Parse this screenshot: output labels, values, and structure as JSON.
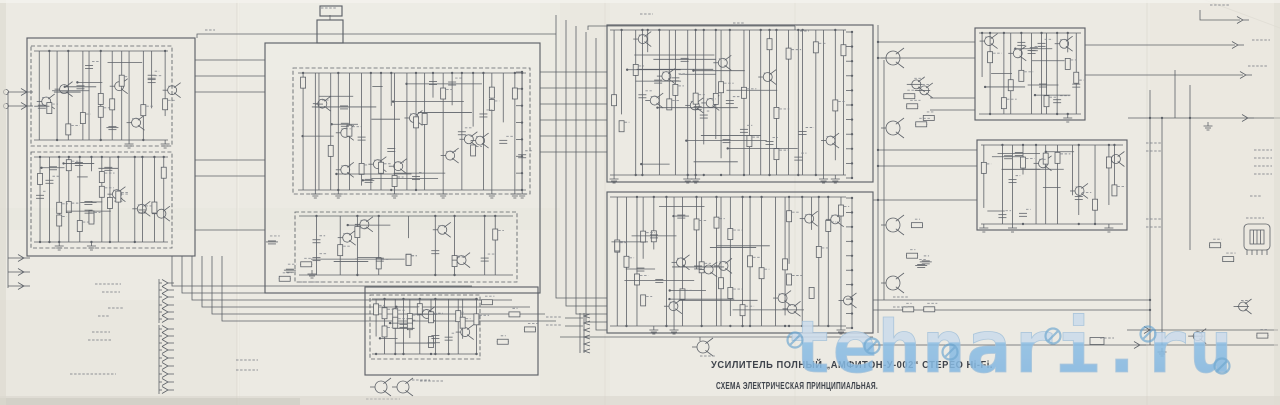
{
  "titles": {
    "line1": "УСИЛИТЕЛЬ ПОЛНЫЙ „АМФИТОН-У-002“ СТЕРЕО Hi-Fi.",
    "line2": "СХЕМА ЭЛЕКТРИЧЕСКАЯ ПРИНЦИПИАЛЬНАЯ."
  },
  "watermark": {
    "text": "tehnari.ru"
  },
  "colors": {
    "paper": "#eceae3",
    "ink": "#4e535b",
    "label": "#7f838a",
    "title": "#3e434b",
    "wm_top": "#cbdbec",
    "wm_bottom": "#8cbee5",
    "wm_outline": "#a2c1da",
    "wm_stamp": "#5e9fce"
  },
  "diagram": {
    "boxes": [
      [
        27,
        38,
        168,
        218,
        0
      ],
      [
        31,
        46,
        141,
        100,
        1
      ],
      [
        31,
        152,
        141,
        96,
        1
      ],
      [
        265,
        43,
        275,
        250,
        0
      ],
      [
        317,
        20,
        26,
        23,
        0
      ],
      [
        320,
        6,
        22,
        10,
        0
      ],
      [
        293,
        68,
        237,
        126,
        1
      ],
      [
        295,
        212,
        222,
        70,
        1
      ],
      [
        365,
        287,
        173,
        88,
        0
      ],
      [
        370,
        295,
        110,
        64,
        1
      ],
      [
        607,
        25,
        266,
        157,
        0
      ],
      [
        607,
        192,
        266,
        141,
        0
      ],
      [
        975,
        28,
        110,
        92,
        0
      ],
      [
        977,
        140,
        150,
        90,
        0
      ]
    ],
    "wires": [
      [
        197,
        38,
        197,
        34,
        556,
        34
      ],
      [
        588,
        30,
        588,
        26,
        795,
        26
      ],
      [
        795,
        26,
        795,
        30
      ],
      [
        556,
        15,
        556,
        298,
        607,
        298
      ],
      [
        566,
        20,
        566,
        306,
        607,
        306
      ],
      [
        576,
        26,
        576,
        314,
        607,
        314
      ],
      [
        586,
        32,
        586,
        322,
        607,
        322
      ],
      [
        596,
        38,
        596,
        330,
        607,
        330
      ],
      [
        195,
        60,
        265,
        60
      ],
      [
        195,
        76,
        265,
        76
      ],
      [
        195,
        92,
        265,
        92
      ],
      [
        195,
        160,
        265,
        160
      ],
      [
        195,
        176,
        265,
        176
      ],
      [
        195,
        230,
        265,
        230
      ],
      [
        540,
        72,
        607,
        72
      ],
      [
        540,
        88,
        607,
        88
      ],
      [
        540,
        104,
        607,
        104
      ],
      [
        540,
        120,
        607,
        120
      ],
      [
        540,
        136,
        607,
        136
      ],
      [
        540,
        152,
        607,
        152
      ],
      [
        172,
        256,
        172,
        286,
        472,
        286
      ],
      [
        182,
        256,
        182,
        293,
        492,
        293
      ],
      [
        192,
        256,
        192,
        300,
        512,
        300
      ],
      [
        202,
        256,
        202,
        307,
        530,
        307
      ],
      [
        212,
        256,
        212,
        314,
        545,
        314
      ],
      [
        222,
        256,
        222,
        321,
        556,
        321
      ],
      [
        560,
        337,
        873,
        337
      ],
      [
        700,
        337,
        700,
        341
      ],
      [
        873,
        345,
        1278,
        345
      ],
      [
        1127,
        330,
        1278,
        330
      ],
      [
        878,
        25,
        878,
        333
      ],
      [
        884,
        60,
        884,
        300
      ],
      [
        878,
        42,
        975,
        42
      ],
      [
        878,
        58,
        975,
        58
      ],
      [
        930,
        98,
        975,
        98
      ],
      [
        930,
        110,
        975,
        110
      ],
      [
        878,
        150,
        977,
        150
      ],
      [
        878,
        166,
        977,
        166
      ],
      [
        873,
        200,
        977,
        200
      ],
      [
        1150,
        90,
        1150,
        345
      ],
      [
        1162,
        118,
        1162,
        345
      ],
      [
        1190,
        85,
        1190,
        250
      ],
      [
        1175,
        70,
        1175,
        118
      ],
      [
        1128,
        118,
        1280,
        118
      ],
      [
        1085,
        45,
        1235,
        45
      ],
      [
        1085,
        75,
        1243,
        75
      ],
      [
        1200,
        10,
        1200,
        20,
        1240,
        20
      ],
      [
        8,
        92,
        8,
        288
      ],
      [
        8,
        92,
        27,
        92
      ],
      [
        8,
        106,
        27,
        106
      ],
      [
        8,
        258,
        24,
        258
      ],
      [
        8,
        272,
        24,
        272
      ],
      [
        8,
        286,
        24,
        286
      ],
      [
        565,
        318,
        583,
        318
      ],
      [
        565,
        326,
        583,
        326
      ],
      [
        330,
        20,
        330,
        15
      ],
      [
        873,
        300,
        1150,
        300
      ],
      [
        873,
        310,
        1150,
        310
      ]
    ],
    "busTicks": [
      {
        "x": 852,
        "y1": 32,
        "y2": 178,
        "n": 11
      },
      {
        "x": 852,
        "y1": 198,
        "y2": 328,
        "n": 10
      },
      {
        "x": 522,
        "y1": 72,
        "y2": 190,
        "n": 8
      }
    ],
    "termGroups": [
      {
        "x": 168,
        "ys": [
          283,
          290,
          297
        ]
      },
      {
        "x": 168,
        "ys": [
          305,
          312,
          319
        ]
      },
      {
        "x": 168,
        "ys": [
          329,
          336,
          343,
          350
        ]
      },
      {
        "x": 168,
        "ys": [
          358,
          366,
          374,
          382,
          390
        ]
      }
    ],
    "terms": [
      [
        1238,
        45
      ],
      [
        1246,
        75
      ],
      [
        1248,
        118
      ],
      [
        1243,
        20
      ],
      [
        1140,
        345
      ],
      [
        1150,
        330
      ],
      [
        24,
        258
      ],
      [
        24,
        272
      ],
      [
        24,
        286
      ],
      [
        27,
        92
      ],
      [
        27,
        106
      ]
    ],
    "squiggles": [
      [
        95,
        284,
        26
      ],
      [
        102,
        292,
        18
      ],
      [
        108,
        308,
        15
      ],
      [
        98,
        316,
        12
      ],
      [
        92,
        332,
        18
      ],
      [
        88,
        340,
        24
      ],
      [
        70,
        374,
        46
      ],
      [
        236,
        360,
        22
      ],
      [
        236,
        370,
        22
      ],
      [
        300,
        282,
        24
      ],
      [
        420,
        381,
        24
      ],
      [
        366,
        399,
        34
      ],
      [
        546,
        317,
        15
      ],
      [
        546,
        325,
        15
      ],
      [
        640,
        14,
        13
      ],
      [
        733,
        23,
        12
      ],
      [
        800,
        31,
        9
      ],
      [
        893,
        297,
        16
      ],
      [
        893,
        307,
        16
      ],
      [
        1100,
        338,
        14
      ],
      [
        1252,
        40,
        18
      ],
      [
        1248,
        66,
        20
      ],
      [
        1254,
        150,
        18
      ],
      [
        1254,
        158,
        18
      ],
      [
        1254,
        166,
        18
      ],
      [
        1254,
        174,
        18
      ],
      [
        1146,
        143,
        15
      ],
      [
        1146,
        151,
        15
      ],
      [
        1146,
        219,
        15
      ],
      [
        1146,
        227,
        15
      ],
      [
        1246,
        218,
        18
      ],
      [
        1250,
        196,
        12
      ],
      [
        205,
        30,
        10
      ],
      [
        321,
        8,
        16
      ],
      [
        1210,
        5,
        20
      ],
      [
        700,
        356,
        15
      ],
      [
        412,
        380,
        18
      ]
    ],
    "parts": [
      {
        "t": "tr",
        "x": 893,
        "y": 58,
        "r": 7
      },
      {
        "t": "tr",
        "x": 893,
        "y": 128,
        "r": 7
      },
      {
        "t": "tr",
        "x": 893,
        "y": 225,
        "r": 7
      },
      {
        "t": "tr",
        "x": 893,
        "y": 283,
        "r": 7
      },
      {
        "t": "tr",
        "x": 703,
        "y": 347,
        "r": 6
      },
      {
        "t": "tr",
        "x": 381,
        "y": 387,
        "r": 6
      },
      {
        "t": "tr",
        "x": 403,
        "y": 387,
        "r": 6
      },
      {
        "t": "plug",
        "x": 1244,
        "y": 224
      },
      {
        "t": "fuse",
        "x": 1090,
        "y": 341
      },
      {
        "t": "phones",
        "x": 584,
        "y": 313
      },
      {
        "t": "gnd",
        "x": 312,
        "y": 270
      },
      {
        "t": "gnd",
        "x": 1208,
        "y": 122
      },
      {
        "t": "gnd",
        "x": 1162,
        "y": 348
      },
      {
        "t": "pad",
        "x": 6,
        "y": 92
      },
      {
        "t": "pad",
        "x": 6,
        "y": 106
      },
      {
        "t": "dot",
        "x": 878,
        "y": 42
      },
      {
        "t": "dot",
        "x": 878,
        "y": 58
      },
      {
        "t": "dot",
        "x": 878,
        "y": 150
      },
      {
        "t": "dot",
        "x": 878,
        "y": 166
      },
      {
        "t": "dot",
        "x": 878,
        "y": 200
      },
      {
        "t": "dot",
        "x": 1150,
        "y": 118
      },
      {
        "t": "dot",
        "x": 1162,
        "y": 118
      },
      {
        "t": "dot",
        "x": 1190,
        "y": 118
      },
      {
        "t": "dot",
        "x": 1150,
        "y": 300
      },
      {
        "t": "dot",
        "x": 1150,
        "y": 310
      }
    ],
    "clusters": [
      [
        34,
        50,
        134,
        92,
        13,
        11,
        1
      ],
      [
        34,
        156,
        134,
        88,
        13,
        22,
        1
      ],
      [
        298,
        72,
        228,
        120,
        24,
        33,
        1
      ],
      [
        299,
        215,
        214,
        62,
        9,
        44,
        1
      ],
      [
        372,
        298,
        106,
        58,
        12,
        55,
        1
      ],
      [
        484,
        302,
        48,
        46,
        4,
        66,
        0
      ],
      [
        610,
        29,
        236,
        148,
        26,
        77,
        1
      ],
      [
        610,
        196,
        236,
        132,
        24,
        88,
        1
      ],
      [
        979,
        32,
        102,
        84,
        11,
        99,
        1
      ],
      [
        981,
        144,
        142,
        82,
        12,
        110,
        1
      ],
      [
        1195,
        245,
        75,
        95,
        5,
        121,
        0
      ],
      [
        268,
        205,
        40,
        80,
        4,
        132,
        0
      ],
      [
        906,
        42,
        26,
        115,
        6,
        143,
        0
      ],
      [
        906,
        212,
        26,
        105,
        6,
        154,
        0
      ]
    ],
    "wm_stamps": [
      [
        795,
        340
      ],
      [
        872,
        346
      ],
      [
        950,
        352
      ],
      [
        1053,
        336
      ],
      [
        1148,
        334
      ],
      [
        1222,
        366
      ]
    ]
  }
}
